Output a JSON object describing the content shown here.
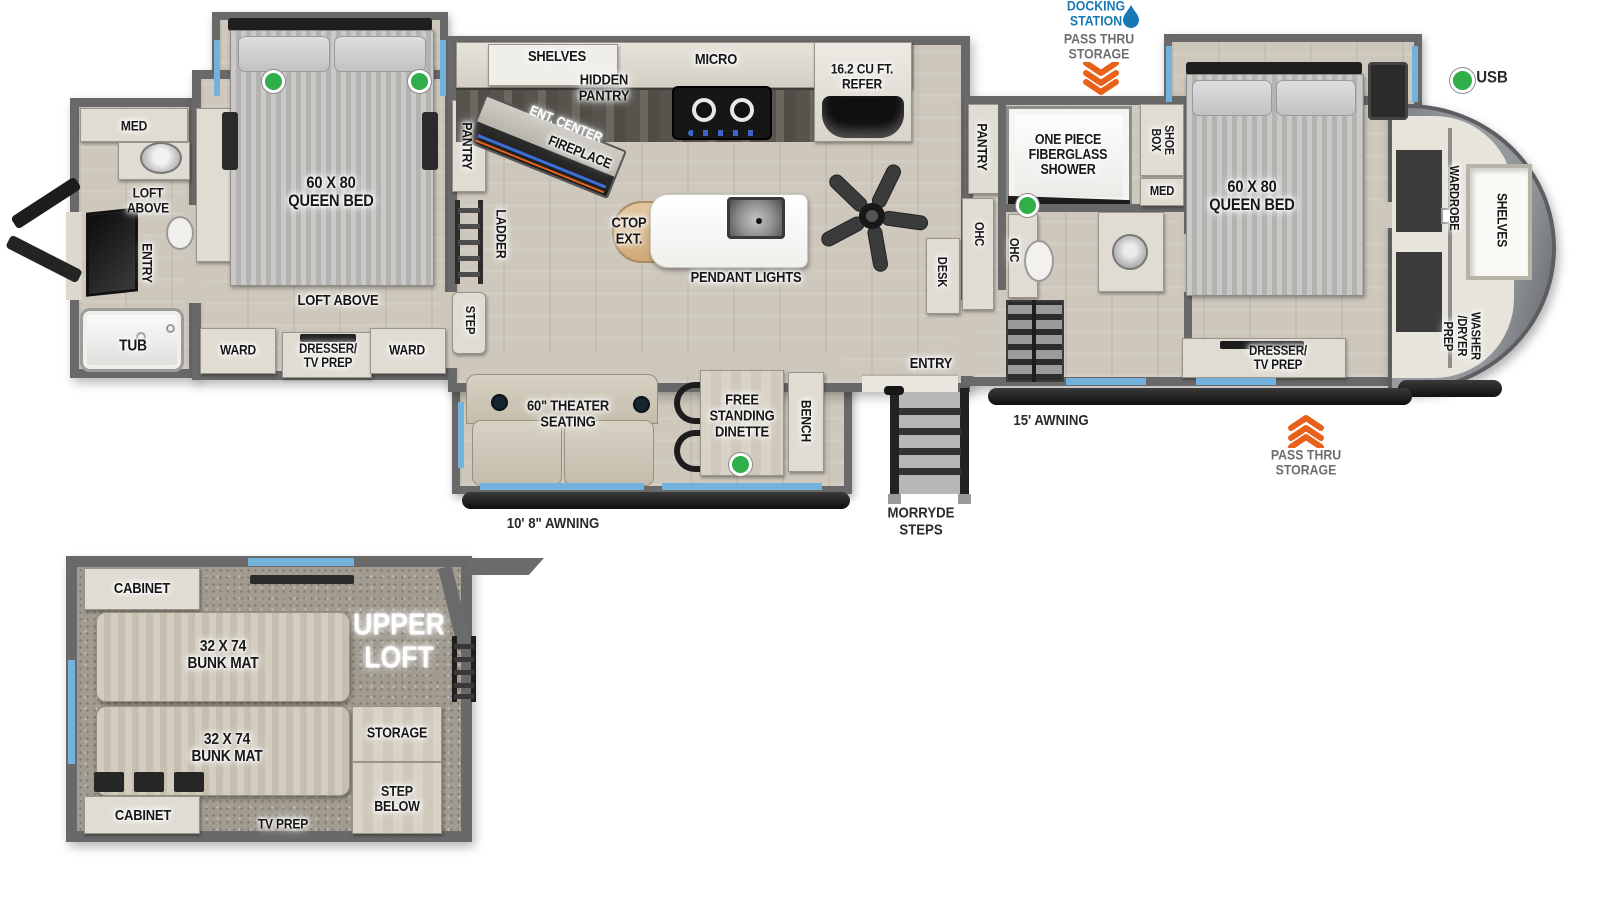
{
  "title": "Fifth wheel RV floor plan with rear bath, two queen bedrooms, kitchen island and upper loft",
  "colors": {
    "accent_blue": "#1878b4",
    "accent_orange": "#e8611a",
    "usb_green": "#2fae4a",
    "window_blue": "#74b2de",
    "wall_gray": "#696969"
  },
  "main": {
    "rear_bath": {
      "med": "MED",
      "loft_above": "LOFT\nABOVE",
      "entry": "ENTRY",
      "tub": "TUB"
    },
    "bedroom2": {
      "bed": "60 X 80\nQUEEN BED",
      "loft_above": "LOFT ABOVE",
      "ward_left": "WARD",
      "dresser": "DRESSER/\nTV PREP",
      "ward_right": "WARD"
    },
    "galley": {
      "pantry": "PANTRY",
      "ladder": "LADDER",
      "step": "STEP"
    },
    "kitchen": {
      "shelves": "SHELVES",
      "hidden_pantry": "HIDDEN\nPANTRY",
      "ent_center": "ENT. CENTER",
      "fireplace": "FIREPLACE",
      "micro": "MICRO",
      "refer": "16.2 CU FT.\nREFER",
      "ctop_ext": "CTOP\nEXT.",
      "pendant_lights": "PENDANT LIGHTS"
    },
    "living": {
      "theater": "60\" THEATER\nSEATING",
      "dinette": "FREE\nSTANDING\nDINETTE",
      "bench": "BENCH",
      "entry": "ENTRY",
      "desk": "DESK"
    },
    "mid_bath": {
      "pantry": "PANTRY",
      "shower": "ONE PIECE\nFIBERGLASS\nSHOWER",
      "shoe_box": "SHOE\nBOX",
      "med": "MED",
      "ohc_left": "OHC",
      "ohc_right": "OHC"
    },
    "bedroom1": {
      "bed": "60 X 80\nQUEEN BED",
      "dresser": "DRESSER/\nTV PREP"
    },
    "front_closet": {
      "wardrobe": "WARDROBE",
      "shelves": "SHELVES",
      "washer_dryer": "WASHER\n/DRYER\nPREP"
    }
  },
  "annotations": {
    "docking_station": "DOCKING\nSTATION",
    "pass_thru_top": "PASS THRU\nSTORAGE",
    "usb": "USB",
    "awning_small": "10' 8\" AWNING",
    "morryde": "MORRYDE\nSTEPS",
    "awning_large": "15' AWNING",
    "pass_thru_bottom": "PASS THRU\nSTORAGE"
  },
  "loft": {
    "cabinet_top": "CABINET",
    "bunk_top": "32 X 74\nBUNK MAT",
    "bunk_bottom": "32 X 74\nBUNK MAT",
    "title": "UPPER\nLOFT",
    "storage": "STORAGE",
    "step_below": "STEP\nBELOW",
    "cabinet_bottom": "CABINET",
    "tv_prep": "TV PREP"
  }
}
